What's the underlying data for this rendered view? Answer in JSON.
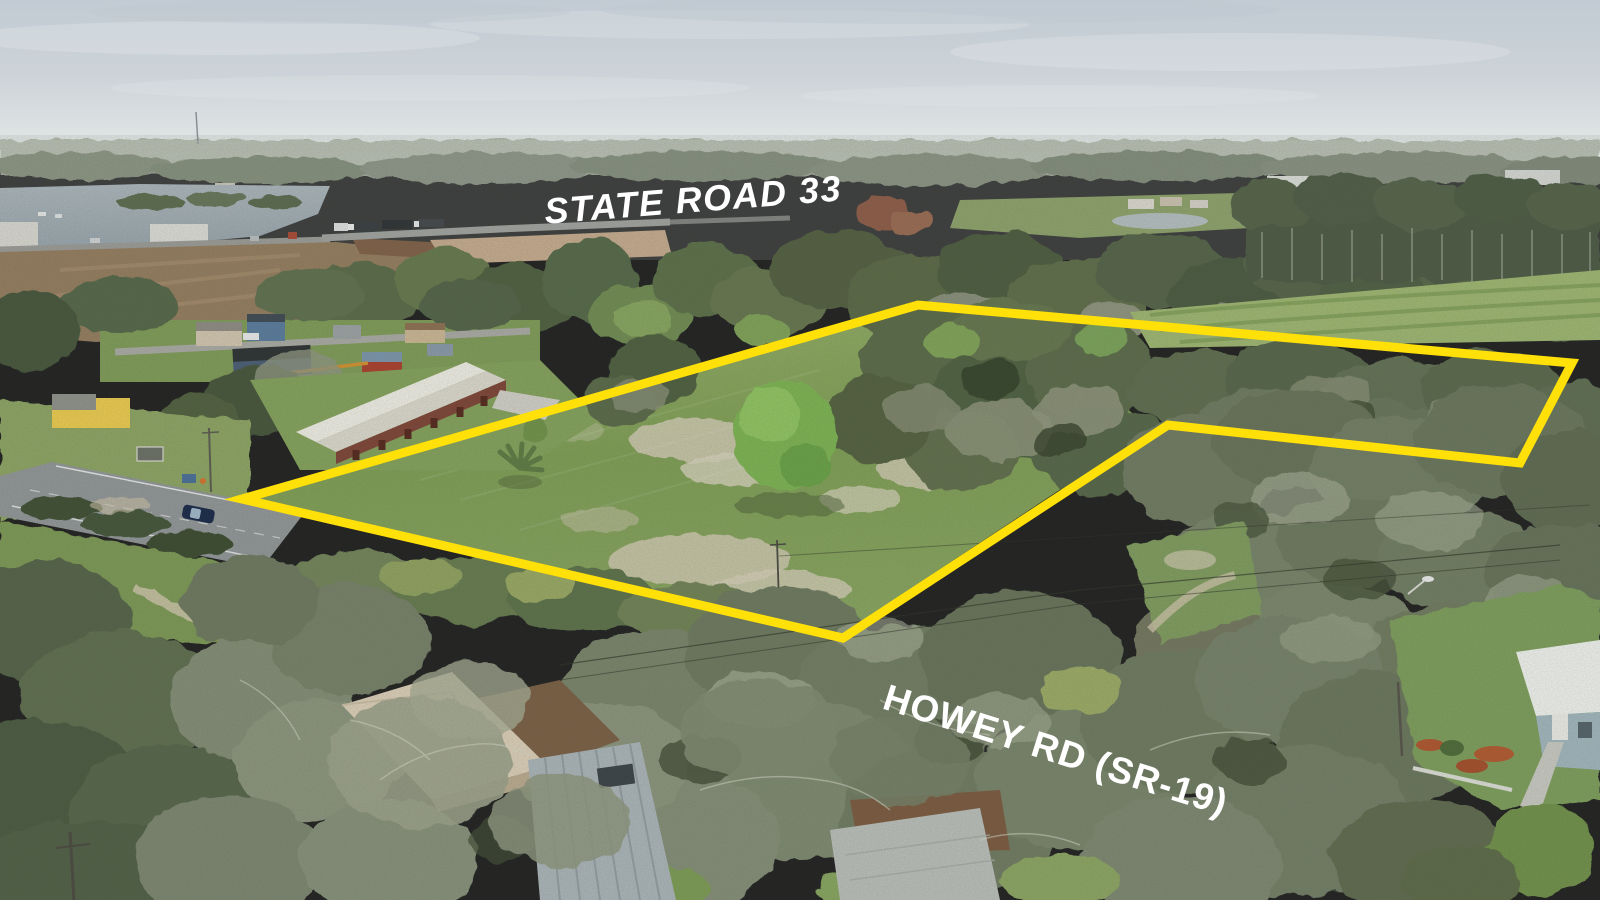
{
  "labels": {
    "top_road": "STATE ROAD 33",
    "bottom_road": "HOWEY RD (SR-19)"
  },
  "parcel": {
    "outline_points": "242,499 918,305 1572,363 1520,463 1168,425 843,638",
    "outline_color": "#FFE008",
    "outline_width": "9",
    "label_color": "#FFFFFF"
  },
  "palette": {
    "accent_yellow": "#FFE008",
    "sky_top": "#c2cbd3",
    "sky_horizon": "#e7e9e8",
    "lake_water": "#a0acb3",
    "pasture_green": "#87a45e",
    "canopy_gray_green": "#7c8670",
    "sand_patch": "#d0c9b4",
    "asphalt": "#909496",
    "barn_roof_white": "#e9e7de",
    "barn_wall_red": "#7d4538"
  }
}
